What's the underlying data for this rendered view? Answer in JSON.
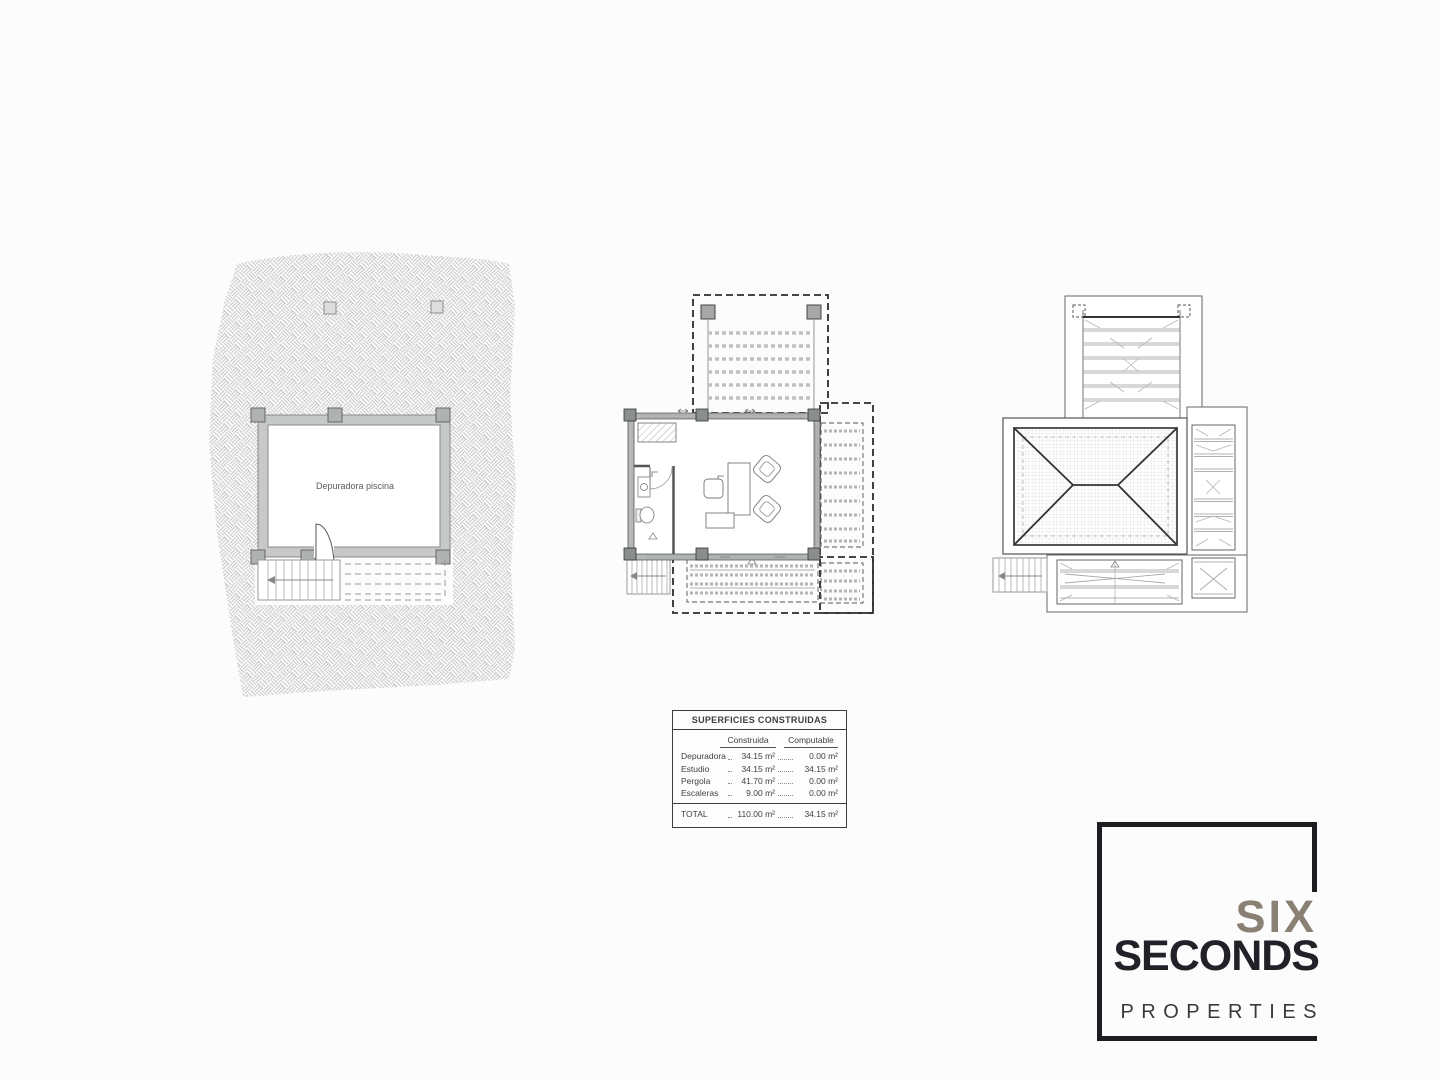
{
  "page": {
    "background": "#fcfcfc",
    "line_color": "#4a4a4a",
    "wall_fill": "#c7c9c9",
    "hatch_color": "#c6c6c6"
  },
  "plans": {
    "site": {
      "room_label": "Depuradora piscina"
    },
    "floor": {
      "name": "estudio-floor-plan"
    },
    "roof": {
      "name": "roof-plan"
    }
  },
  "surfaces_table": {
    "title": "SUPERFICIES CONSTRUIDAS",
    "columns": [
      "Construida",
      "Computable"
    ],
    "rows": [
      {
        "label": "Depuradora",
        "construida": "34.15 m²",
        "computable": "0.00 m²"
      },
      {
        "label": "Estudio",
        "construida": "34.15 m²",
        "computable": "34.15 m²"
      },
      {
        "label": "Pergola",
        "construida": "41.70 m²",
        "computable": "0.00 m²"
      },
      {
        "label": "Escaleras",
        "construida": "9.00 m²",
        "computable": "0.00 m²"
      }
    ],
    "total": {
      "label": "TOTAL",
      "construida": "110.00 m²",
      "computable": "34.15 m²"
    }
  },
  "logo": {
    "line1": "SIX",
    "line2": "SECONDS",
    "line3": "PROPERTIES",
    "accent_color": "#8a8174",
    "dark_color": "#232127"
  }
}
